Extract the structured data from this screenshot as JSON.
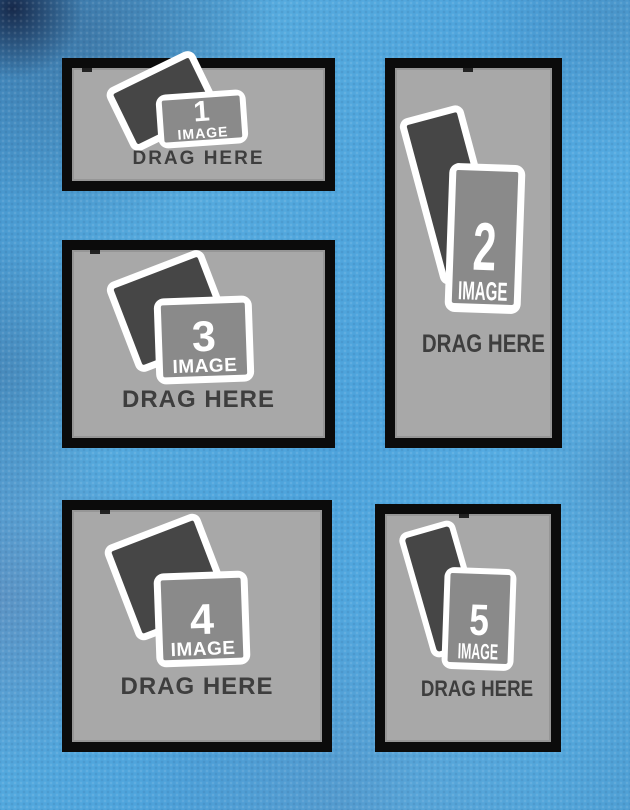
{
  "template": {
    "name": "photo-collage-drop-template",
    "slot_count": 5
  },
  "colors": {
    "background_blue": "#4ba1da",
    "frame_black": "#0b0b0b",
    "placeholder_gray": "#a8a8a8",
    "icon_back_gray": "#464646",
    "icon_front_gray": "#8a8a8a",
    "icon_white": "#ffffff",
    "drag_text_gray": "#3e3e3e"
  },
  "slots": [
    {
      "number": "1",
      "image_label": "IMAGE",
      "drag_label": "DRAG HERE",
      "orientation": "landscape"
    },
    {
      "number": "2",
      "image_label": "IMAGE",
      "drag_label": "DRAG HERE",
      "orientation": "portrait"
    },
    {
      "number": "3",
      "image_label": "IMAGE",
      "drag_label": "DRAG HERE",
      "orientation": "landscape"
    },
    {
      "number": "4",
      "image_label": "IMAGE",
      "drag_label": "DRAG HERE",
      "orientation": "square"
    },
    {
      "number": "5",
      "image_label": "IMAGE",
      "drag_label": "DRAG HERE",
      "orientation": "portrait"
    }
  ]
}
